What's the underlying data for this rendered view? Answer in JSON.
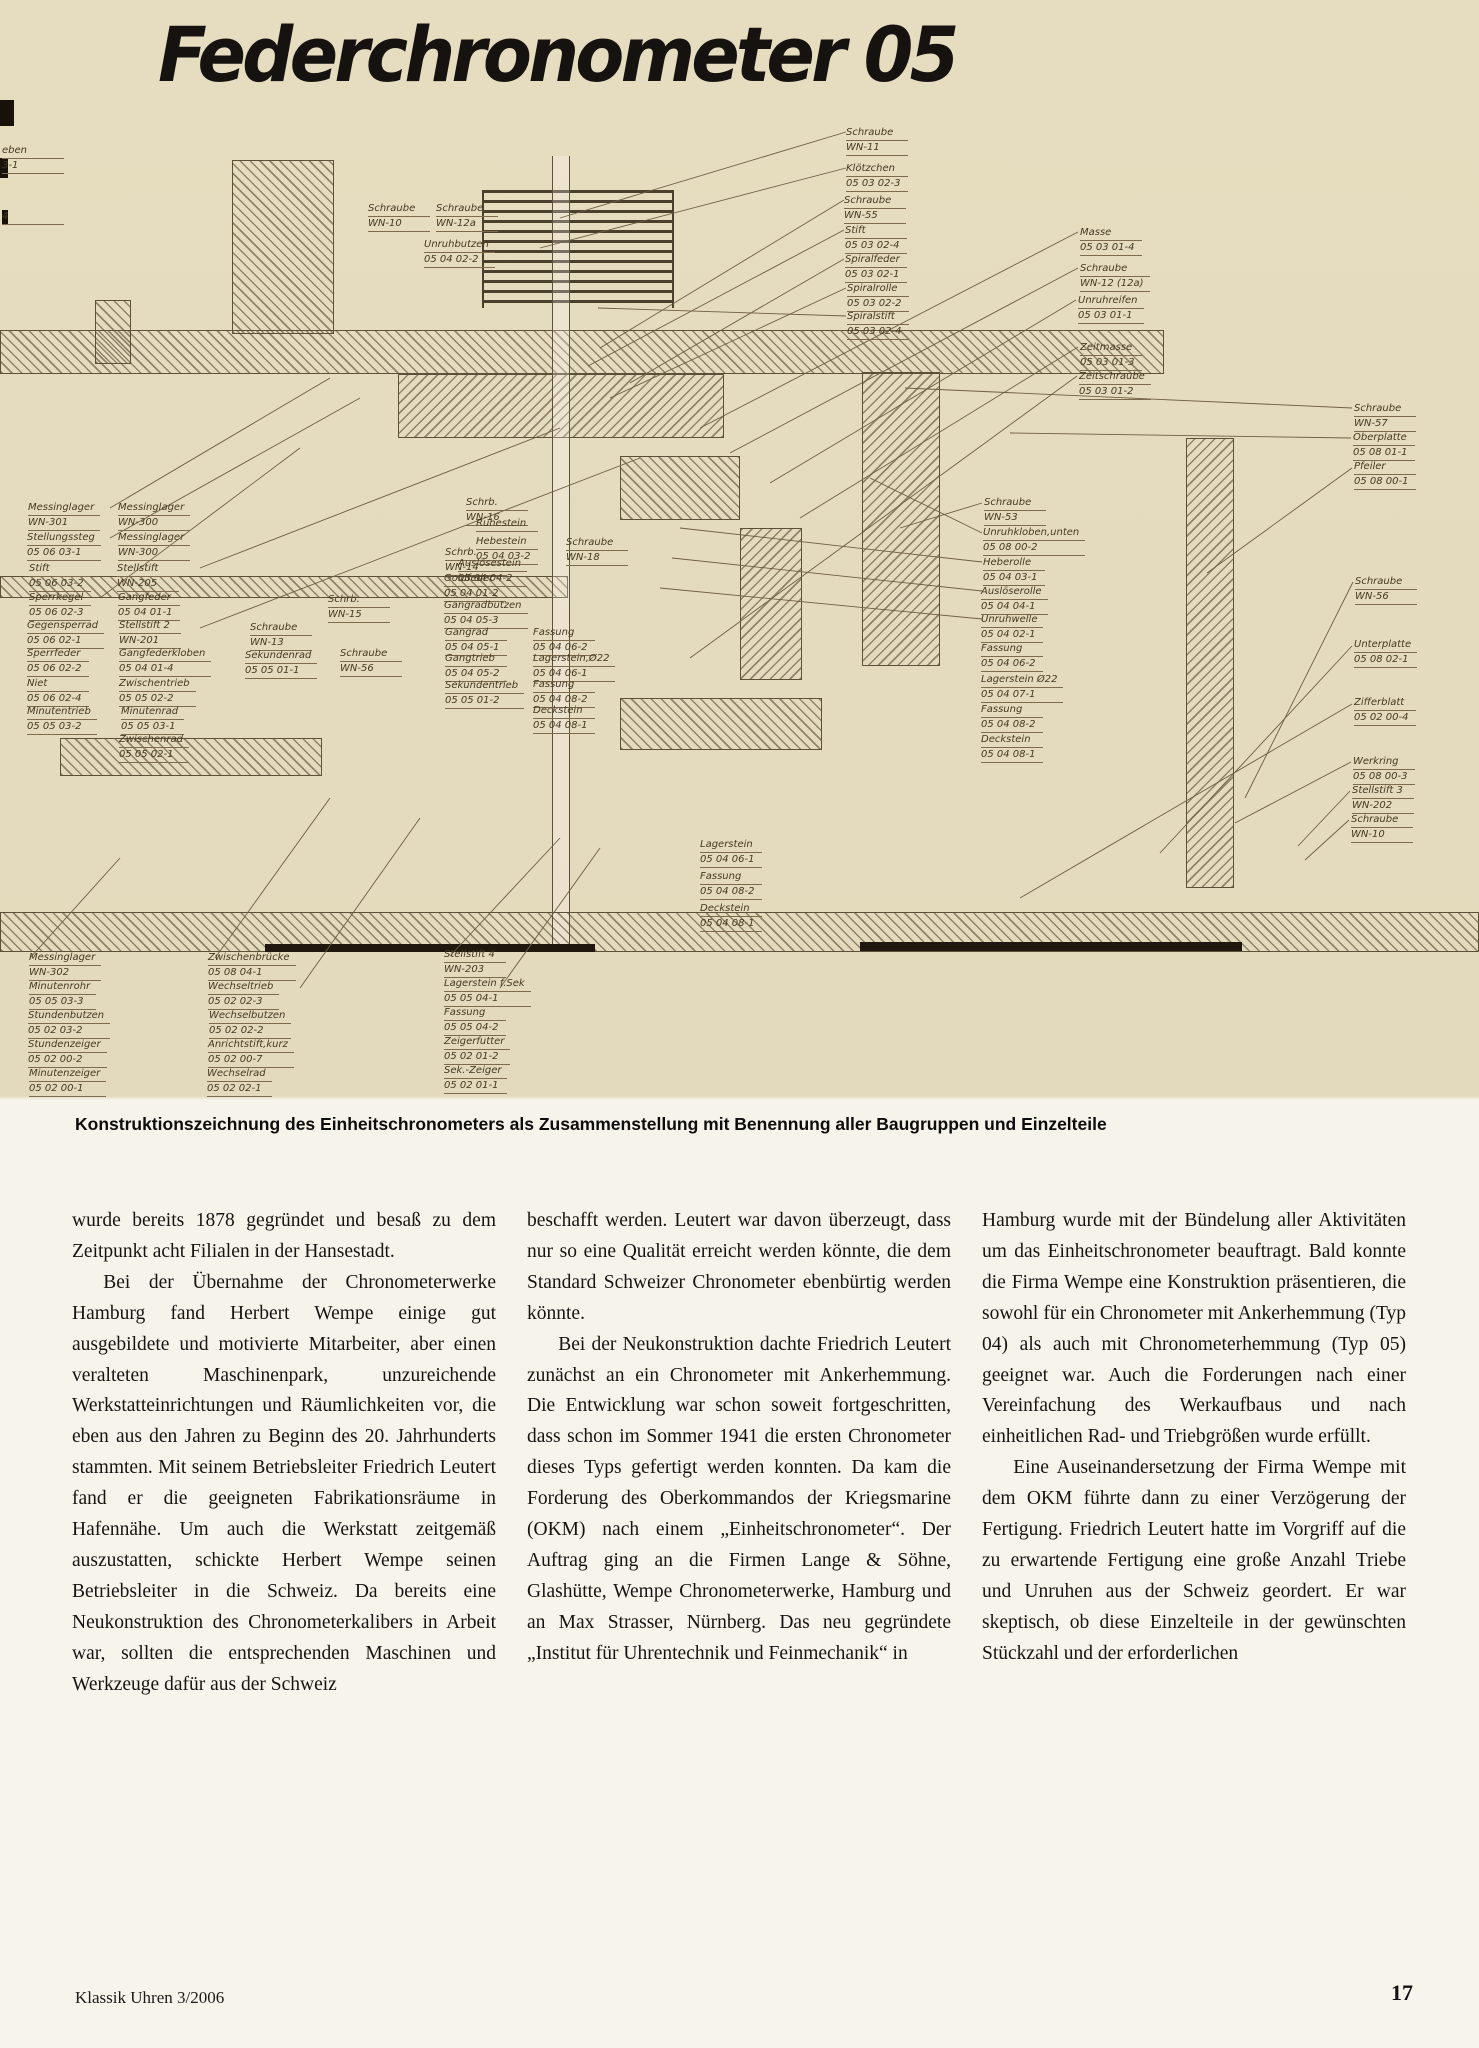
{
  "page": {
    "title": "Federchronometer 05",
    "caption": "Konstruktionszeichnung des Einheitschronometers als Zusammenstellung mit Benennung aller Baugruppen und Einzelteile",
    "footer_left": "Klassik Uhren 3/2006",
    "page_number": "17"
  },
  "drawing": {
    "labels": [
      {
        "name": "eben",
        "code": "3-1",
        "x": 2,
        "y": 46
      },
      {
        "name": "4",
        "code": "",
        "x": 2,
        "y": 112
      },
      {
        "name": "Schraube",
        "code": "WN-10",
        "x": 368,
        "y": 104
      },
      {
        "name": "Schraube",
        "code": "WN-12a",
        "x": 436,
        "y": 104
      },
      {
        "name": "Unruhbutzen",
        "code": "05 04 02-2",
        "x": 424,
        "y": 140
      },
      {
        "name": "Schraube",
        "code": "WN-11",
        "x": 846,
        "y": 28
      },
      {
        "name": "Klötzchen",
        "code": "05 03 02-3",
        "x": 846,
        "y": 64
      },
      {
        "name": "Schraube",
        "code": "WN-55",
        "x": 844,
        "y": 96
      },
      {
        "name": "Stift",
        "code": "05 03 02-4",
        "x": 845,
        "y": 126
      },
      {
        "name": "Spiralfeder",
        "code": "05 03 02-1",
        "x": 845,
        "y": 155
      },
      {
        "name": "Spiralrolle",
        "code": "05 03 02-2",
        "x": 847,
        "y": 184
      },
      {
        "name": "Spiralstift",
        "code": "05 03 02-4",
        "x": 847,
        "y": 212
      },
      {
        "name": "Masse",
        "code": "05 03 01-4",
        "x": 1080,
        "y": 128
      },
      {
        "name": "Schraube",
        "code": "WN-12 (12a)",
        "x": 1080,
        "y": 164
      },
      {
        "name": "Unruhreifen",
        "code": "05 03 01-1",
        "x": 1078,
        "y": 196
      },
      {
        "name": "Zeitmasse",
        "code": "05 03 01-3",
        "x": 1080,
        "y": 243
      },
      {
        "name": "Zeitschraube",
        "code": "05 03 01-2",
        "x": 1079,
        "y": 272
      },
      {
        "name": "Schraube",
        "code": "WN-57",
        "x": 1354,
        "y": 304
      },
      {
        "name": "Oberplatte",
        "code": "05 08 01-1",
        "x": 1353,
        "y": 333
      },
      {
        "name": "Pfeiler",
        "code": "05 08 00-1",
        "x": 1354,
        "y": 362
      },
      {
        "name": "Schraube",
        "code": "WN-56",
        "x": 1355,
        "y": 477
      },
      {
        "name": "Unterplatte",
        "code": "05 08 02-1",
        "x": 1354,
        "y": 540
      },
      {
        "name": "Zifferblatt",
        "code": "05 02 00-4",
        "x": 1354,
        "y": 598
      },
      {
        "name": "Werkring",
        "code": "05 08 00-3",
        "x": 1353,
        "y": 657
      },
      {
        "name": "Stellstift 3",
        "code": "WN-202",
        "x": 1352,
        "y": 686
      },
      {
        "name": "Schraube",
        "code": "WN-10",
        "x": 1351,
        "y": 715
      },
      {
        "name": "Schraube",
        "code": "WN-53",
        "x": 984,
        "y": 398
      },
      {
        "name": "Unruhkloben,unten",
        "code": "05 08 00-2",
        "x": 983,
        "y": 428
      },
      {
        "name": "Heberolle",
        "code": "05 04 03-1",
        "x": 983,
        "y": 458
      },
      {
        "name": "Auslöserolle",
        "code": "05 04 04-1",
        "x": 981,
        "y": 487
      },
      {
        "name": "Unruhwelle",
        "code": "05 04 02-1",
        "x": 981,
        "y": 515
      },
      {
        "name": "Fassung",
        "code": "05 04 06-2",
        "x": 981,
        "y": 544
      },
      {
        "name": "Lagerstein Ø22",
        "code": "05 04 07-1",
        "x": 981,
        "y": 575
      },
      {
        "name": "Fassung",
        "code": "05 04 08-2",
        "x": 981,
        "y": 605
      },
      {
        "name": "Deckstein",
        "code": "05 04 08-1",
        "x": 981,
        "y": 635
      },
      {
        "name": "Messinglager",
        "code": "WN-301",
        "x": 28,
        "y": 403
      },
      {
        "name": "Stellungssteg",
        "code": "05 06 03-1",
        "x": 27,
        "y": 433
      },
      {
        "name": "Stift",
        "code": "05 06 03-2",
        "x": 29,
        "y": 464
      },
      {
        "name": "Sperrkegel",
        "code": "05 06 02-3",
        "x": 29,
        "y": 493
      },
      {
        "name": "Gegensperrad",
        "code": "05 06 02-1",
        "x": 27,
        "y": 521
      },
      {
        "name": "Sperrfeder",
        "code": "05 06 02-2",
        "x": 27,
        "y": 549
      },
      {
        "name": "Niet",
        "code": "05 06 02-4",
        "x": 27,
        "y": 579
      },
      {
        "name": "Minutentrieb",
        "code": "05 05 03-2",
        "x": 27,
        "y": 607
      },
      {
        "name": "Messinglager",
        "code": "WN-300",
        "x": 118,
        "y": 403
      },
      {
        "name": "Messinglager",
        "code": "WN-300",
        "x": 118,
        "y": 433
      },
      {
        "name": "Stellstift",
        "code": "WN-205",
        "x": 117,
        "y": 464
      },
      {
        "name": "Gangfeder",
        "code": "05 04 01-1",
        "x": 118,
        "y": 493
      },
      {
        "name": "Stellstift 2",
        "code": "WN-201",
        "x": 119,
        "y": 521
      },
      {
        "name": "Gangfederkloben",
        "code": "05 04 01-4",
        "x": 119,
        "y": 549
      },
      {
        "name": "Zwischentrieb",
        "code": "05 05 02-2",
        "x": 119,
        "y": 579
      },
      {
        "name": "Minutenrad",
        "code": "05 05 03-1",
        "x": 121,
        "y": 607
      },
      {
        "name": "Zwischenrad",
        "code": "05 05 02-1",
        "x": 119,
        "y": 635
      },
      {
        "name": "Schrb.",
        "code": "WN-15",
        "x": 328,
        "y": 495
      },
      {
        "name": "Schraube",
        "code": "WN-13",
        "x": 250,
        "y": 523
      },
      {
        "name": "Sekundenrad",
        "code": "05 05 01-1",
        "x": 245,
        "y": 551
      },
      {
        "name": "Schraube",
        "code": "WN-56",
        "x": 340,
        "y": 549
      },
      {
        "name": "Schrb.",
        "code": "WN-14",
        "x": 445,
        "y": 448
      },
      {
        "name": "Goldfeder",
        "code": "05 04 01-2",
        "x": 444,
        "y": 474
      },
      {
        "name": "Gangradbutzen",
        "code": "05 04 05-3",
        "x": 444,
        "y": 501
      },
      {
        "name": "Gangrad",
        "code": "05 04 05-1",
        "x": 445,
        "y": 528
      },
      {
        "name": "Gangtrieb",
        "code": "05 04 05-2",
        "x": 445,
        "y": 554
      },
      {
        "name": "Sekundentrieb",
        "code": "05 05 01-2",
        "x": 445,
        "y": 581
      },
      {
        "name": "Schrb.",
        "code": "WN-16",
        "x": 466,
        "y": 398
      },
      {
        "name": "Ruhestein",
        "code": "",
        "x": 476,
        "y": 419
      },
      {
        "name": "Hebestein",
        "code": "05 04 03-2",
        "x": 476,
        "y": 437
      },
      {
        "name": "Auslösestein",
        "code": "05 04 04-2",
        "x": 458,
        "y": 459
      },
      {
        "name": "Schraube",
        "code": "WN-18",
        "x": 566,
        "y": 438
      },
      {
        "name": "Fassung",
        "code": "05 04 06-2",
        "x": 533,
        "y": 528
      },
      {
        "name": "Lagerstein,Ø22",
        "code": "05 04 06-1",
        "x": 533,
        "y": 554
      },
      {
        "name": "Fassung",
        "code": "05 04 08-2",
        "x": 533,
        "y": 580
      },
      {
        "name": "Deckstein",
        "code": "05 04 08-1",
        "x": 533,
        "y": 606
      },
      {
        "name": "Lagerstein",
        "code": "05 04 06-1",
        "x": 700,
        "y": 740
      },
      {
        "name": "Fassung",
        "code": "05 04 08-2",
        "x": 700,
        "y": 772
      },
      {
        "name": "Deckstein",
        "code": "05 04 08-1",
        "x": 700,
        "y": 804
      },
      {
        "name": "Messinglager",
        "code": "WN-302",
        "x": 29,
        "y": 853
      },
      {
        "name": "Minutenrohr",
        "code": "05 05 03-3",
        "x": 29,
        "y": 882
      },
      {
        "name": "Stundenbutzen",
        "code": "05 02 03-2",
        "x": 28,
        "y": 911
      },
      {
        "name": "Stundenzeiger",
        "code": "05 02 00-2",
        "x": 28,
        "y": 940
      },
      {
        "name": "Minutenzeiger",
        "code": "05 02 00-1",
        "x": 29,
        "y": 969
      },
      {
        "name": "Zwischenbrücke",
        "code": "05 08 04-1",
        "x": 208,
        "y": 853
      },
      {
        "name": "Wechseltrieb",
        "code": "05 02 02-3",
        "x": 208,
        "y": 882
      },
      {
        "name": "Wechselbutzen",
        "code": "05 02 02-2",
        "x": 209,
        "y": 911
      },
      {
        "name": "Anrichtstift,kurz",
        "code": "05 02 00-7",
        "x": 208,
        "y": 940
      },
      {
        "name": "Wechselrad",
        "code": "05 02 02-1",
        "x": 207,
        "y": 969
      },
      {
        "name": "Stellstift 4",
        "code": "WN-203",
        "x": 444,
        "y": 850
      },
      {
        "name": "Lagerstein f.Sek",
        "code": "05 05 04-1",
        "x": 444,
        "y": 879
      },
      {
        "name": "Fassung",
        "code": "05 05 04-2",
        "x": 444,
        "y": 908
      },
      {
        "name": "Zeigerfutter",
        "code": "05 02 01-2",
        "x": 444,
        "y": 937
      },
      {
        "name": "Sek.-Zeiger",
        "code": "05 02 01-1",
        "x": 444,
        "y": 966
      }
    ]
  },
  "article": {
    "columns": [
      {
        "paragraphs": [
          {
            "indent": false,
            "text": "wurde bereits 1878 gegründet und besaß zu dem Zeitpunkt acht Filialen in der Hansestadt."
          },
          {
            "indent": true,
            "text": "Bei der Übernahme der Chronometerwerke Hamburg fand Herbert Wempe einige gut ausgebildete und motivierte Mitarbeiter, aber einen veralteten Maschinenpark, unzureichende Werkstatteinrichtungen und Räumlichkeiten vor, die eben aus den Jahren zu Beginn des 20. Jahrhunderts stammten. Mit seinem Betriebsleiter Friedrich Leutert fand er die geeigneten Fabrikationsräume in Hafennähe. Um auch die Werkstatt zeitgemäß auszustatten, schickte Herbert Wempe seinen Betriebsleiter in die Schweiz. Da bereits eine Neukonstruktion des Chronometerkalibers in Arbeit war, sollten die entsprechenden Maschinen und Werkzeuge dafür aus der Schweiz"
          }
        ]
      },
      {
        "paragraphs": [
          {
            "indent": false,
            "text": "beschafft werden. Leutert war davon überzeugt, dass nur so eine Qualität erreicht werden könnte, die dem Standard Schweizer Chronometer ebenbürtig werden könnte."
          },
          {
            "indent": true,
            "text": "Bei der Neukonstruktion dachte Friedrich Leutert zunächst an ein Chronometer mit Ankerhemmung. Die Entwicklung war schon soweit fortgeschritten, dass schon im Sommer 1941 die ersten Chronometer dieses Typs gefertigt werden konnten. Da kam die Forderung des Oberkommandos der Kriegsmarine (OKM) nach einem „Einheitschronometer“. Der Auftrag ging an die Firmen Lange & Söhne, Glashütte, Wempe Chronometerwerke, Hamburg und an Max Strasser, Nürnberg. Das neu gegründete „Institut für Uhrentechnik und Feinmechanik“ in"
          }
        ]
      },
      {
        "paragraphs": [
          {
            "indent": false,
            "text": "Hamburg wurde mit der Bündelung aller Aktivitäten um das Einheitschronometer beauftragt. Bald konnte die Firma Wempe eine Konstruktion präsentieren, die sowohl für ein Chronometer mit Ankerhemmung (Typ 04) als auch mit Chronometerhemmung (Typ 05) geeignet war. Auch die Forderungen nach einer Vereinfachung des Werkaufbaus und nach einheitlichen Rad- und Triebgrößen wurde erfüllt."
          },
          {
            "indent": true,
            "text": "Eine Auseinandersetzung der Firma Wempe mit dem OKM führte dann zu einer Verzögerung der Fertigung. Friedrich Leutert hatte im Vorgriff auf die zu erwartende Fertigung eine große Anzahl Triebe und Unruhen aus der Schweiz geordert. Er war skeptisch, ob diese Einzelteile in der gewünschten Stückzahl und der erforderlichen"
          }
        ]
      }
    ]
  }
}
